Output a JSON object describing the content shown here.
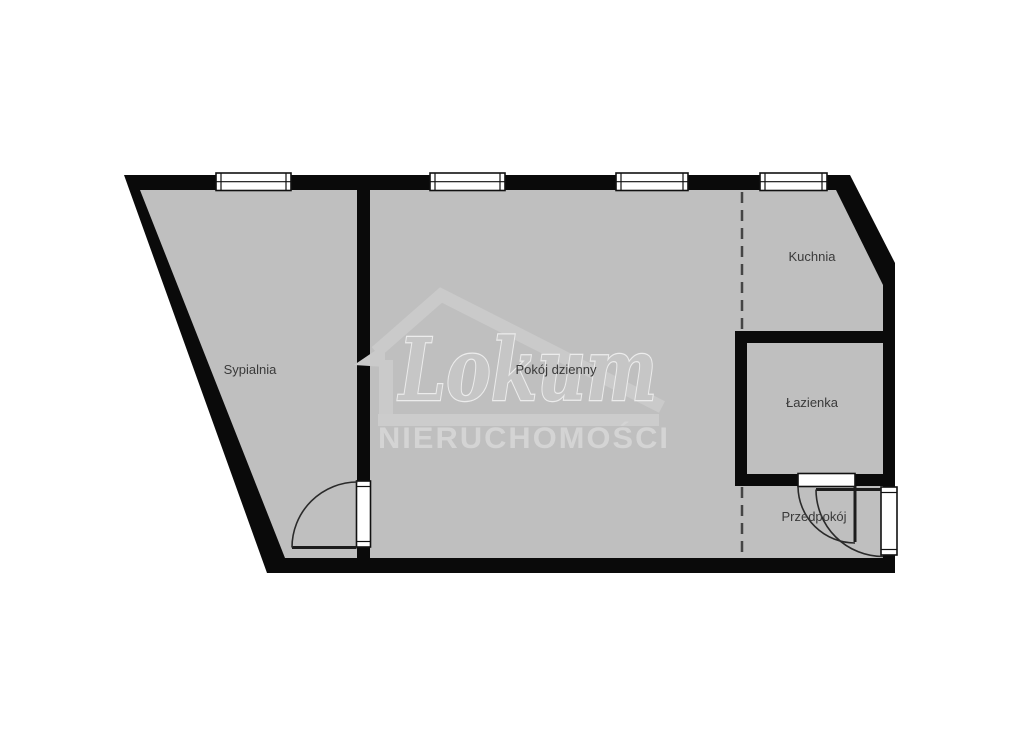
{
  "page": {
    "background_color": "#ffffff"
  },
  "floorplan": {
    "floor_color": "#bfbfbf",
    "wall_color": "#0a0a0a",
    "label_color": "#3a3a3a",
    "rooms": [
      {
        "id": "sypialnia",
        "label": "Sypialnia"
      },
      {
        "id": "pokoj-dzienny",
        "label": "Pokój dzienny"
      },
      {
        "id": "kuchnia",
        "label": "Kuchnia"
      },
      {
        "id": "lazienka",
        "label": "Łazienka"
      },
      {
        "id": "przedpokoj",
        "label": "Przedpokój"
      }
    ],
    "window_count": 4,
    "door_count": 3
  },
  "watermark": {
    "brand": "Lokum",
    "subtitle": "NIERUCHOMOŚCI",
    "icon": "house-outline-icon",
    "color": "#cacaca"
  }
}
